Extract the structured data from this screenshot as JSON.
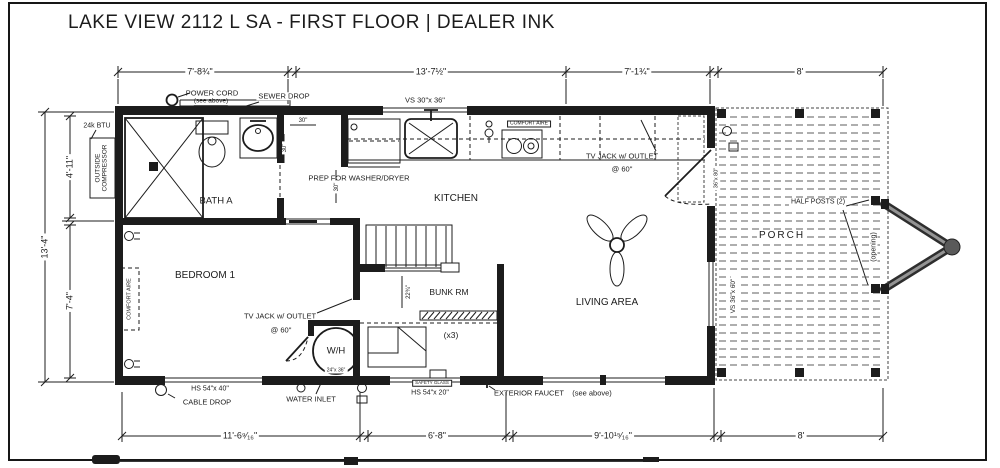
{
  "title": "LAKE VIEW 2112 L SA - FIRST FLOOR | DEALER INK",
  "ink_color": "#1c1c1c",
  "dims": {
    "top": [
      "7'-8¾\"",
      "13'-7½\"",
      "7'-1¾\"",
      "8'"
    ],
    "bottom": [
      "11'-6⁹⁄₁₆\"",
      "6'-8\"",
      "9'-10¹⁵⁄₁₆\"",
      "8'"
    ],
    "left": {
      "overall": "13'-4\"",
      "upper": "4'-11\"",
      "lower": "7'-4\""
    }
  },
  "rooms": {
    "bath": "BATH A",
    "bedroom": "BEDROOM 1",
    "kitchen": "KITCHEN",
    "bunk": "BUNK RM",
    "bunk_count": "(x3)",
    "living": "LIVING AREA",
    "porch": "PORCH"
  },
  "annotations": {
    "power_cord": "POWER CORD",
    "power_cord_note": "(see above)",
    "sewer_drop": "SEWER DROP",
    "btu": "24k BTU",
    "outside_compressor": "OUTSIDE COMPRESSOR",
    "kitchen_window": "VS 30\"x 36\"",
    "comfort_aire_kitchen": "COMFORT AIRE",
    "comfort_aire_bedroom": "COMFORT AIRE",
    "prep_wd": "PREP FOR WASHER/DRYER",
    "tv_jack": "TV JACK w/ OUTLET",
    "tv_jack_height": "@ 60\"",
    "water_heater": "W/H",
    "water_heater_size": "24\"x 36\"",
    "water_inlet": "WATER INLET",
    "cable_drop": "CABLE DROP",
    "exterior_faucet": "EXTERIOR FAUCET",
    "exterior_faucet_note": "(see above)",
    "bedroom_window": "HS 54\"x 40\"",
    "bunk_window": "HS 54\"x 20\"",
    "bunk_window_glass": "SAFETY GLASS",
    "living_window": "VS 36\"x 60\"",
    "entry_door_size": "36\"x 80\"",
    "half_posts": "HALF POSTS (2)",
    "porch_opening": "(opening)",
    "dim_30_w": "30\"",
    "dim_30_h": "30\"",
    "dim_30_gap": "30\"",
    "dim_bunk_entry": "22¾\""
  }
}
